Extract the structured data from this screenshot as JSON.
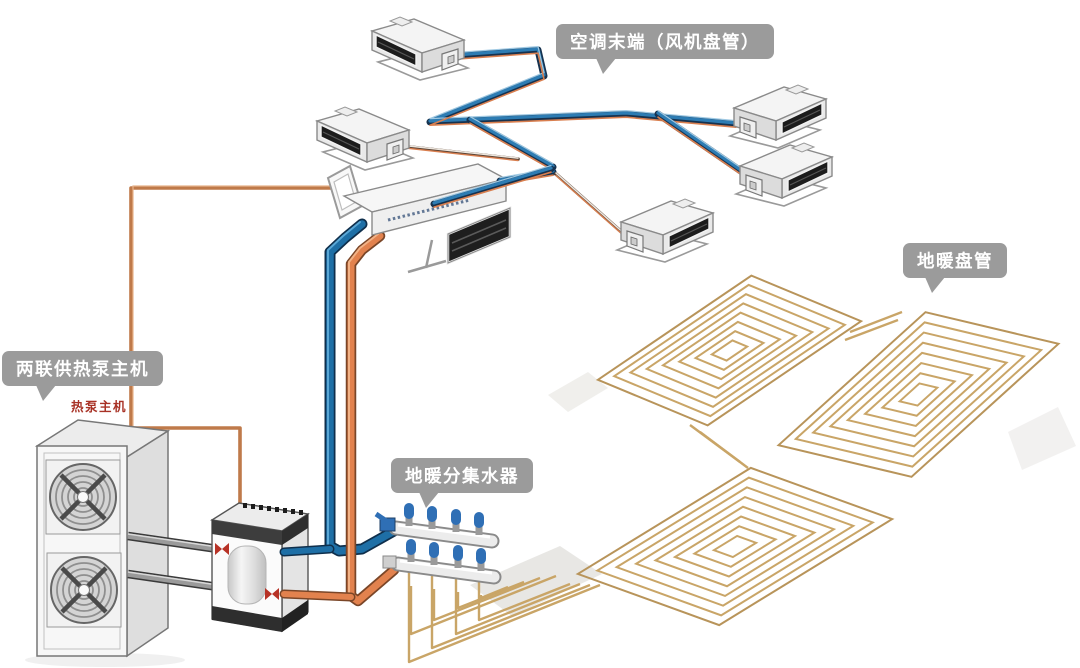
{
  "callouts": {
    "ac_terminal": {
      "text": "空调末端（风机盘管）"
    },
    "floor_coil": {
      "text": "地暖盘管"
    },
    "heat_pump": {
      "text": "两联供热泵主机"
    },
    "manifold": {
      "text": "地暖分集水器"
    }
  },
  "annotations": {
    "heat_pump_unit": "热泵主机"
  },
  "colors": {
    "background": "#ffffff",
    "callout_bg": "#9b9b9b",
    "callout_text": "#ffffff",
    "pipe_cold_blue": "#2d7cb3",
    "pipe_cold_dark": "#16324f",
    "pipe_hot_orange": "#d97f4f",
    "pipe_loop_orange": "#bf7a4a",
    "pipe_gray": "#9a9a9a",
    "floor_coil_tan": "#c9a567",
    "valve_red": "#b73226",
    "manifold_valve_blue": "#2f6fb5",
    "annotation_red": "#a83226"
  }
}
